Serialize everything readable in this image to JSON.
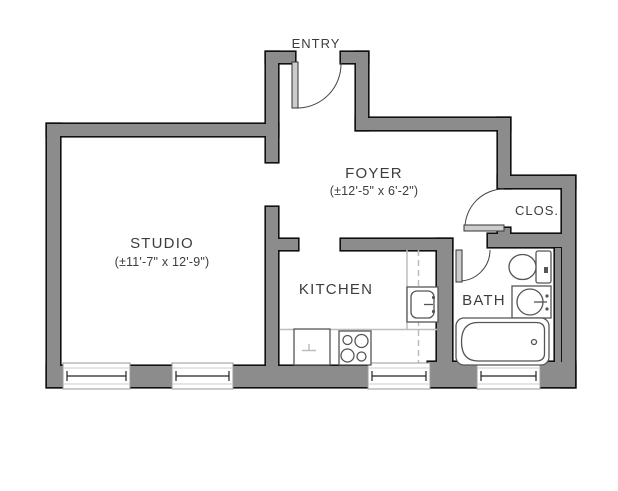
{
  "colors": {
    "background": "#ffffff",
    "wall_fill": "#8c8c8c",
    "wall_outline": "#111111",
    "door_fill": "#cccccc",
    "fixture_stroke": "#555555",
    "counter_line": "#bdbdbd",
    "text": "#3d3d3d"
  },
  "rooms": {
    "entry": {
      "label": "ENTRY"
    },
    "foyer": {
      "label": "FOYER",
      "dimensions": "(±12'-5\" x 6'-2\")"
    },
    "studio": {
      "label": "STUDIO",
      "dimensions": "(±11'-7\" x 12'-9\")"
    },
    "kitchen": {
      "label": "KITCHEN"
    },
    "bath": {
      "label": "BATH"
    },
    "closet": {
      "label": "CLOS."
    }
  },
  "doors": [
    {
      "name": "entry-door",
      "location": "entry",
      "swing": "into foyer"
    },
    {
      "name": "closet-door",
      "location": "closet",
      "swing": "into foyer"
    },
    {
      "name": "bath-door",
      "location": "bath",
      "swing": "into bath"
    }
  ],
  "windows": [
    {
      "location": "studio",
      "wall": "bottom"
    },
    {
      "location": "studio",
      "wall": "bottom"
    },
    {
      "location": "kitchen",
      "wall": "bottom"
    },
    {
      "location": "bath",
      "wall": "bottom"
    }
  ],
  "fixtures": [
    {
      "name": "toilet",
      "room": "bath"
    },
    {
      "name": "sink",
      "room": "bath"
    },
    {
      "name": "bathtub",
      "room": "bath"
    },
    {
      "name": "sink",
      "room": "kitchen"
    },
    {
      "name": "stove-4-burner",
      "room": "kitchen"
    },
    {
      "name": "refrigerator",
      "room": "kitchen"
    }
  ]
}
